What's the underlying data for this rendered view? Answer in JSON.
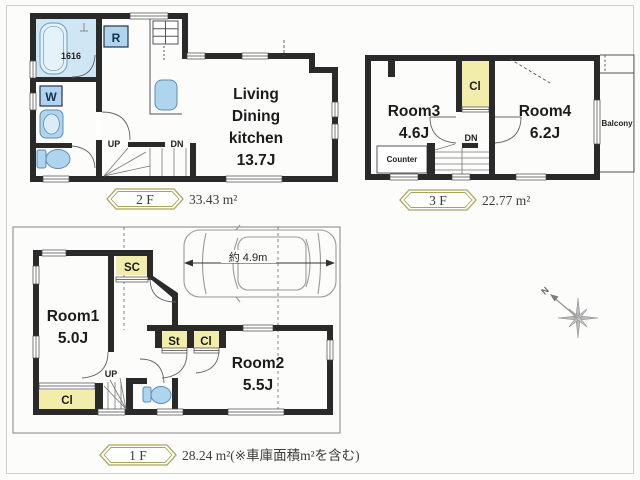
{
  "colors": {
    "wall": "#2a2a2a",
    "closet_yellow": "#f2edaa",
    "fixture_blue": "#aed4ee",
    "bath_floor": "#cfe7f5",
    "badge_border": "#a9a35b",
    "thin_line": "#555555",
    "car_gray": "#999999"
  },
  "floor2": {
    "badge": "2 F",
    "area": "33.43 m²",
    "ldk": [
      "Living",
      "Dining",
      "kitchen",
      "13.7J"
    ],
    "labels": {
      "fridge": "R",
      "washer": "W",
      "bath_size": "1616",
      "up": "UP",
      "dn": "DN"
    }
  },
  "floor3": {
    "badge": "3 F",
    "area": "22.77 m²",
    "room3": [
      "Room3",
      "4.6J"
    ],
    "room4": [
      "Room4",
      "6.2J"
    ],
    "labels": {
      "closet": "Cl",
      "counter": "Counter",
      "dn": "DN",
      "balcony": "Balcony"
    }
  },
  "floor1": {
    "badge": "1 F",
    "area": "28.24 m²(※車庫面積m²を含む)",
    "room1": [
      "Room1",
      "5.0J"
    ],
    "room2": [
      "Room2",
      "5.5J"
    ],
    "labels": {
      "shoe_closet": "SC",
      "storage": "St",
      "closet_hall": "Cl",
      "closet_room1": "Cl",
      "up": "UP",
      "car_length": "約 4.9m"
    }
  },
  "compass": {
    "north": "N"
  }
}
